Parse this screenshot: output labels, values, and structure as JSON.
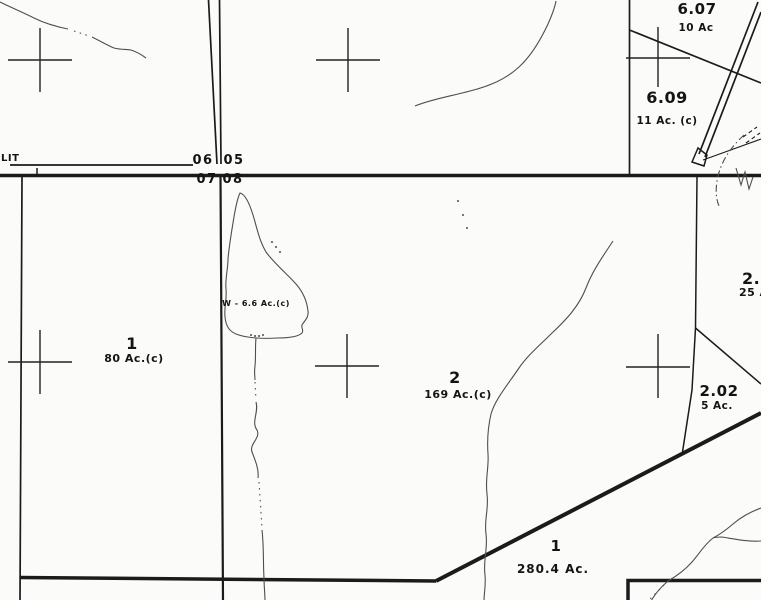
{
  "edge_text": "LIT",
  "section_corners": {
    "nw": "06",
    "ne": "05",
    "sw": "07",
    "se": "08"
  },
  "parcels": {
    "p607": {
      "id": "6.07",
      "acreage": "10 Ac"
    },
    "p609": {
      "id": "6.09",
      "acreage": "11 Ac. (c)"
    },
    "p1_west": {
      "id": "1",
      "acreage": "80 Ac.(c)"
    },
    "p2": {
      "id": "2",
      "acreage": "169 Ac.(c)"
    },
    "p201": {
      "id": "2.0",
      "acreage": "25 A"
    },
    "p202": {
      "id": "2.02",
      "acreage": "5 Ac."
    },
    "p1_south": {
      "id": "1",
      "acreage": "280.4 Ac."
    }
  },
  "water": {
    "label": "W - 6.6 Ac.(c)"
  },
  "symbols": {
    "section_corner_marker": "cross",
    "road_style": "double-line",
    "stream_style": "thin-wavy-line"
  },
  "colors": {
    "background": "#fbfbf9",
    "line": "#1b1b1b",
    "stream": "#4e4e4e",
    "text": "#141414"
  }
}
